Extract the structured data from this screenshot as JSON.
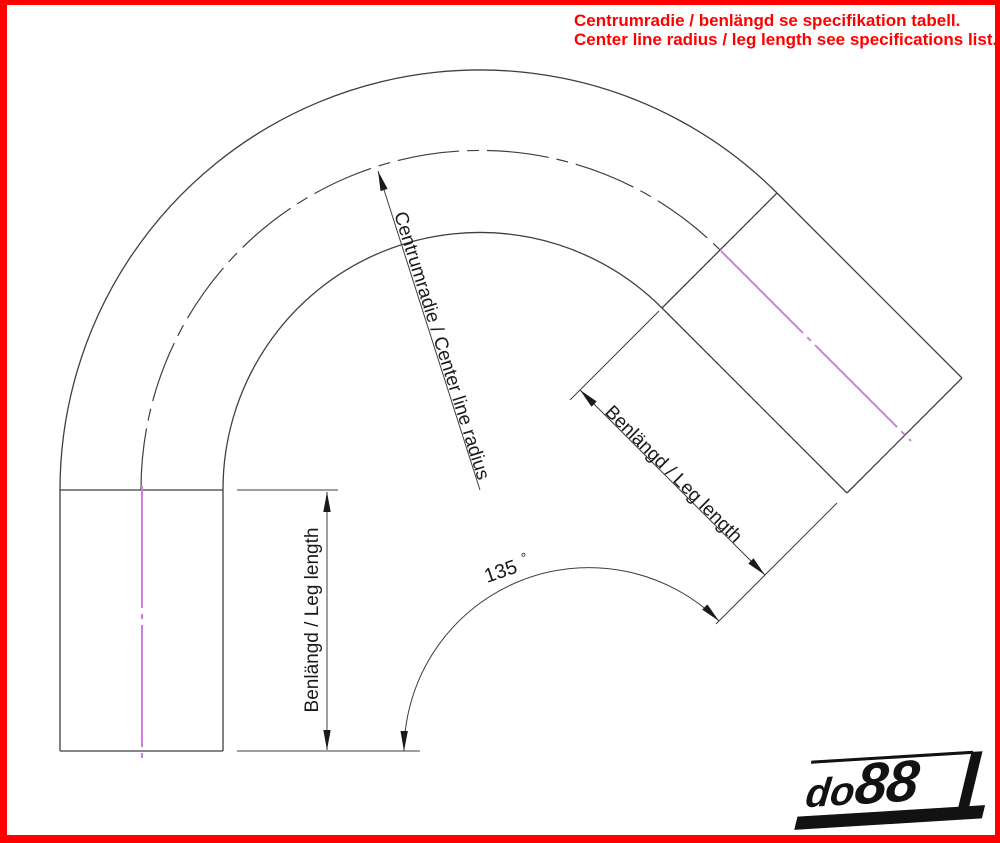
{
  "annotation": {
    "line1": "Centrumradie / benlängd se specifikation tabell.",
    "line2": "Center line radius / leg length see specifications list."
  },
  "dimensions": {
    "center_radius_label": "Centrumradie / Center line radius",
    "left_leg_label": "Benlängd / Leg length",
    "right_leg_label": "Benlängd / Leg length",
    "bend_angle_value": "135",
    "bend_angle_unit": "°"
  },
  "logo": {
    "prefix": "do",
    "suffix": "88"
  },
  "colors": {
    "annotation_red": "#FF0000",
    "border_red": "#FF0000",
    "centerline_magenta": "#C882D8",
    "drawing_line_gray": "#3F3F3F"
  }
}
